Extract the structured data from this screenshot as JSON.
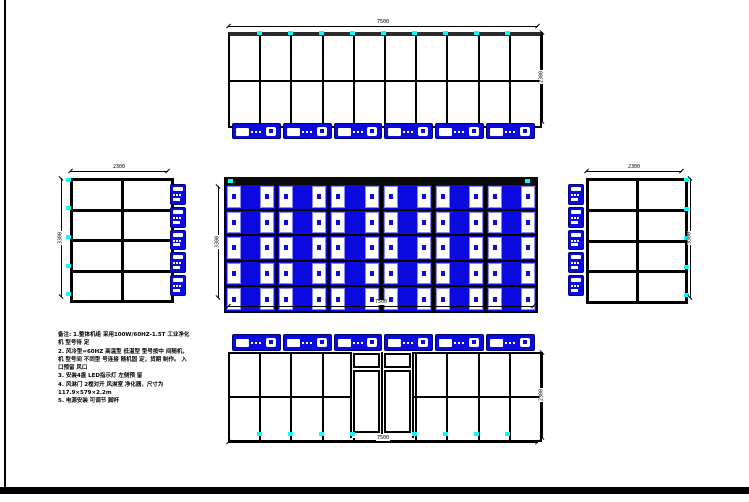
{
  "notes": {
    "lines": [
      "备注: 1.整体机组 采用100W/60HZ-1.5T 工业净化",
      "机 型号待 定",
      "2. 风冷型=60HZ 高温型 低温型 型号按中 间随机，",
      "机 型号间 不同型 号连接 随机固 定，货期 制作。 入",
      "口预留 风口",
      "3. 安装4盏 LED指示灯 左侧预 留",
      "4. 风淋门 2樘对开 风淋室 净化器，尺寸为",
      "117.9×579×2.2m",
      "5. 电源安装 可调节 脚杯"
    ]
  },
  "views": {
    "top": {
      "columns": 10,
      "rows": 2,
      "units": 6,
      "dim_width": "7500",
      "dim_height": "2300"
    },
    "plan": {
      "columns": 6,
      "rows": 5,
      "dim_width": "7500",
      "dim_depth": "3300"
    },
    "left_side": {
      "columns": 2,
      "rows": 4,
      "units": 5,
      "dim_width": "2300",
      "dim_height": "3300"
    },
    "right_side": {
      "columns": 2,
      "rows": 4,
      "units": 5,
      "dim_width": "2300",
      "dim_height": "3300"
    },
    "bottom": {
      "columns": 10,
      "rows": 2,
      "units": 6,
      "door_leaves": 2,
      "dim_width": "7500",
      "dim_height": "2300"
    }
  },
  "colors": {
    "equipment_blue": "#0b0be0",
    "marker_cyan": "#00ffff",
    "line_black": "#000000"
  }
}
